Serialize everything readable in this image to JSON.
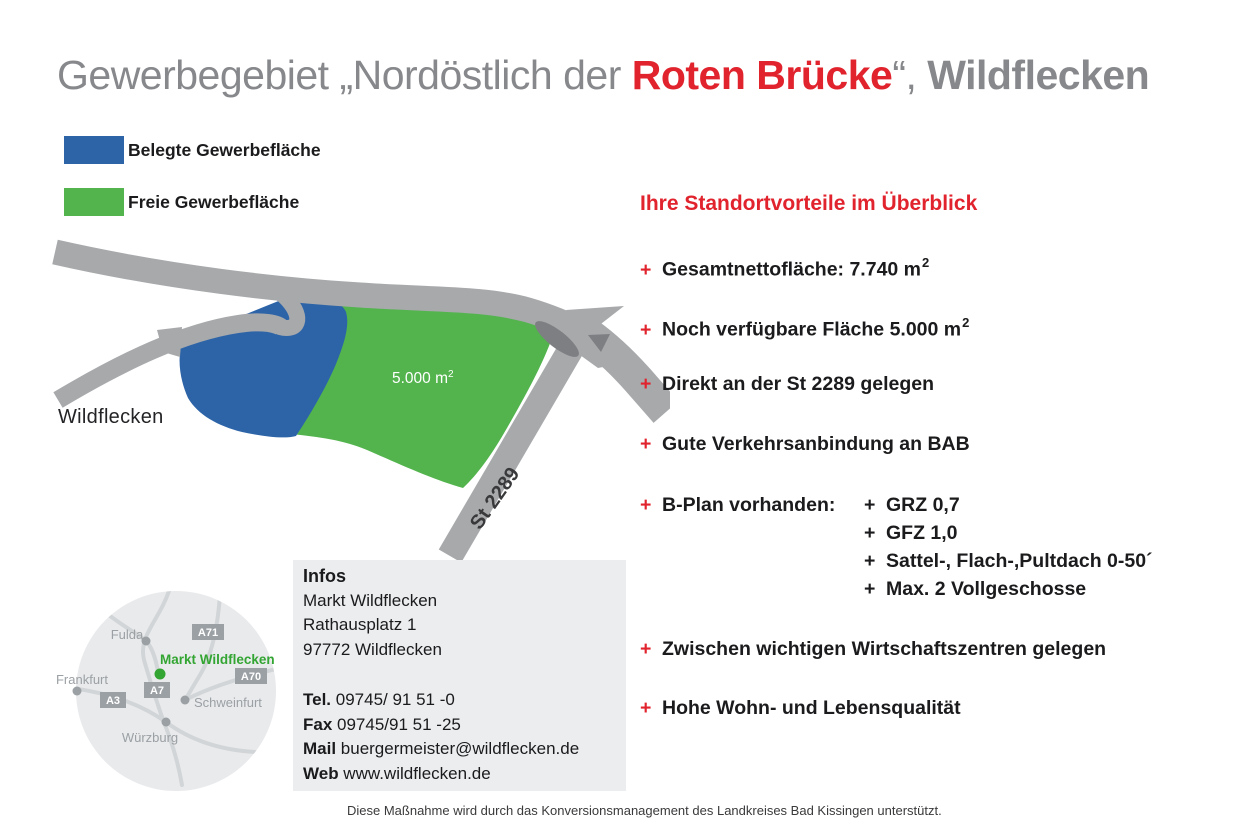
{
  "title": {
    "prefix": "Gewerbegebiet „Nordöstlich der ",
    "highlight": "Roten Brücke",
    "quote_close": "“, ",
    "suffix": "Wildflecken"
  },
  "legend": {
    "items": [
      {
        "label": "Belegte Gewerbefläche",
        "color": "#2d64a8"
      },
      {
        "label": "Freie Gewerbefläche",
        "color": "#53b44e"
      }
    ]
  },
  "map": {
    "town": "Wildflecken",
    "road": "St 2289",
    "area": "5.000 m",
    "area_sup": "2"
  },
  "minimap": {
    "marker_label": "Markt Wildflecken",
    "cities": [
      {
        "name": "Fulda"
      },
      {
        "name": "Frankfurt"
      },
      {
        "name": "Schweinfurt"
      },
      {
        "name": "Würzburg"
      }
    ],
    "highways": [
      {
        "name": "A71"
      },
      {
        "name": "A70"
      },
      {
        "name": "A7"
      },
      {
        "name": "A3"
      }
    ]
  },
  "infobox": {
    "heading": "Infos",
    "address": [
      "Markt Wildflecken",
      "Rathausplatz 1",
      "97772 Wildflecken"
    ],
    "contacts": [
      {
        "label": "Tel.",
        "value": " 09745/ 91 51 -0"
      },
      {
        "label": "Fax",
        "value": " 09745/91 51 -25"
      },
      {
        "label": "Mail",
        "value": " buergermeister@wildflecken.de"
      },
      {
        "label": "Web",
        "value": " www.wildflecken.de"
      }
    ]
  },
  "advantages": {
    "heading": "Ihre Standortvorteile im Überblick",
    "bullet": "+",
    "items": [
      {
        "label": "Gesamtnettofläche: 7.740 m",
        "sup": "2"
      },
      {
        "label": "Noch verfügbare Fläche 5.000 m",
        "sup": "2"
      },
      {
        "label": "Direkt an der St 2289 gelegen"
      },
      {
        "label": "Gute Verkehrsanbindung an BAB"
      },
      {
        "label": "B-Plan vorhanden:"
      },
      {
        "label": "Zwischen wichtigen Wirtschaftszentren gelegen"
      },
      {
        "label": "Hohe Wohn- und Lebensqualität"
      }
    ],
    "bplan_details": [
      {
        "bullet": "+",
        "label": "GRZ 0,7"
      },
      {
        "bullet": "+",
        "label": "GFZ 1,0"
      },
      {
        "bullet": "+",
        "label": "Sattel-, Flach-,Pultdach 0-50´"
      },
      {
        "bullet": "+",
        "label": "Max. 2 Vollgeschosse"
      }
    ]
  },
  "footer": "Diese Maßnahme wird durch das Konversionsmanagement des Landkreises Bad Kissingen unterstützt.",
  "colors": {
    "accent_red": "#e1232d",
    "occupied_blue": "#2d64a8",
    "free_green": "#53b44e",
    "road_gray": "#a7a9ab",
    "dark_gray": "#7d7f82",
    "title_gray": "#87888b",
    "minimap_circle": "#e9eaec",
    "minimap_road": "#d2d5d7",
    "minimap_text": "#9ba0a4",
    "marker_green": "#33a532",
    "infobox_bg": "#ebedee"
  }
}
